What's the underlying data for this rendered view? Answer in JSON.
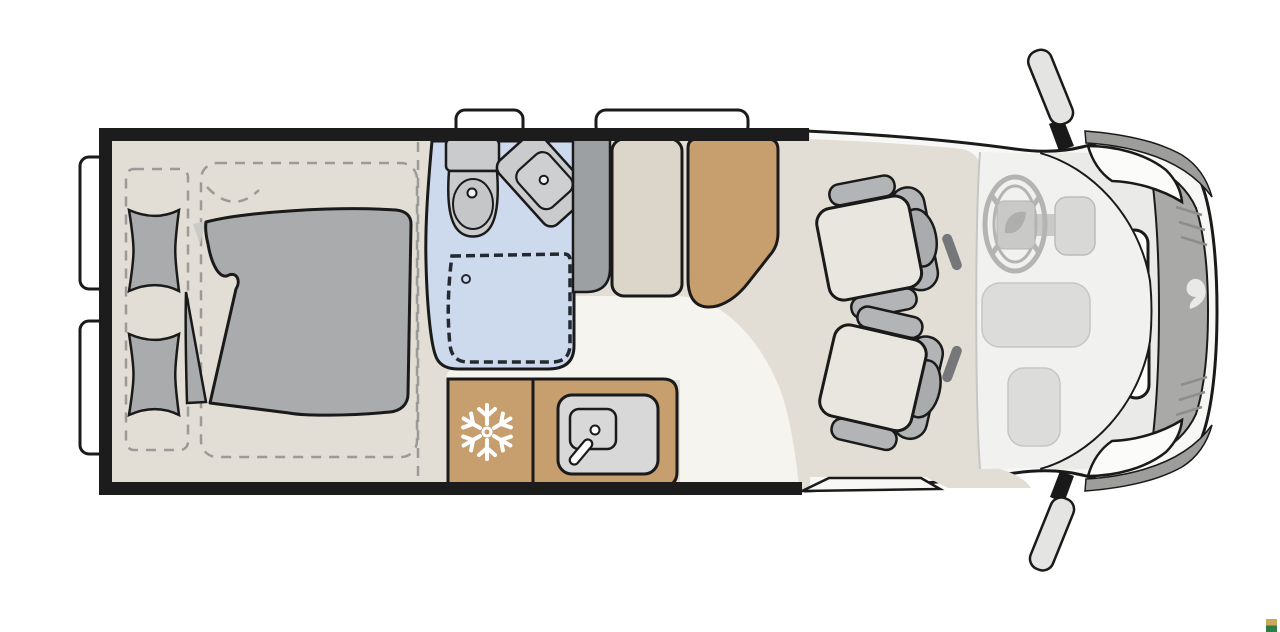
{
  "meta": {
    "type": "vehicle-floorplan",
    "subject": "Camper van motorhome floor plan, top view, cab at right",
    "rooms_count": 5
  },
  "palette": {
    "wall": "#1c1c1c",
    "outline": "#1a1a1a",
    "floor": "#e3ded5",
    "aisle": "#f6f4ee",
    "bathroom": "#cdd9ec",
    "fixture": "#c9cbcd",
    "basin": "#cdcfd1",
    "soft": "#a9abad",
    "wardrobe": "#9da0a3",
    "bench": "#dcd6ca",
    "tan": "#c79e6d",
    "cushion": "#e9e6df",
    "seatGray": "#b2b4b6",
    "headrest": "#a9abad",
    "body": "#f7f7f5",
    "dashArea": "#f1f1ef",
    "hood": "#eaeae8",
    "front": "#a9a9a7",
    "corner": "#9d9d9b",
    "unit": "#d7d8d7",
    "mirror": "#e4e4e2",
    "window": "#ffffff",
    "snow": "#ffffff",
    "step": "#f7f7f5"
  },
  "rooms": {
    "bedroom": {
      "label": "Rear bedroom with double bed",
      "items": [
        "pillow",
        "pillow",
        "duvet",
        "dashed bed outline"
      ]
    },
    "bathroom": {
      "label": "Bathroom with toilet, washbasin and shower"
    },
    "wardrobe": {
      "label": "Wardrobe"
    },
    "lounge": {
      "label": "Bench seat"
    },
    "dinette": {
      "label": "Upholstered travel seat"
    },
    "kitchen": {
      "label": "Kitchen block with refrigerator, sink and two-burner hob"
    },
    "cab": {
      "label": "Driver cab with two swivel seats, steering wheel and dashboard"
    }
  },
  "vehicle": {
    "windows": 4,
    "mirrors": 2,
    "logo": "brand swoosh on front grille"
  },
  "marker": {
    "top": "#c9a85a",
    "bottom": "#2e7d46"
  }
}
